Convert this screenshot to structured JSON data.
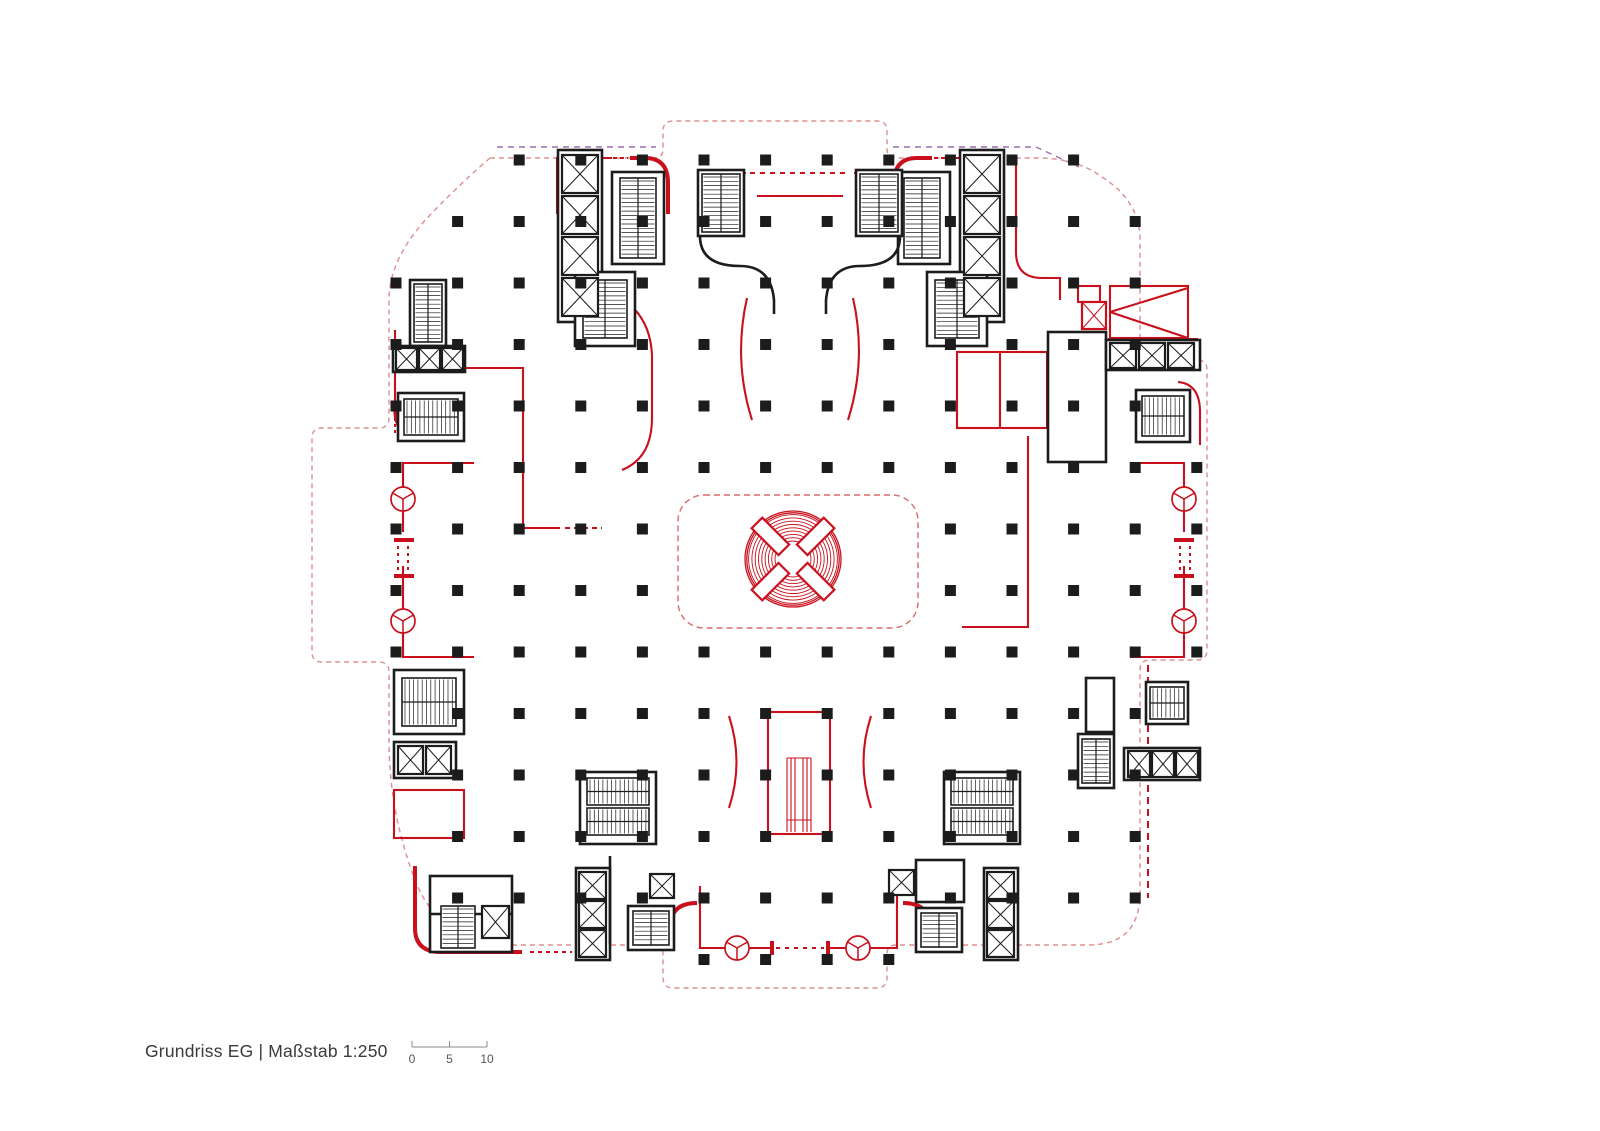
{
  "title": "Grundriss EG | Maßstab 1:250",
  "scale_bar": {
    "labels": [
      "0",
      "5",
      "10"
    ],
    "tick_x": [
      412,
      449.5,
      487
    ],
    "line_y": 1047,
    "tick_top": 1041,
    "label_y": 1063,
    "x_start": 412,
    "x_end": 487
  },
  "colors": {
    "red": "#c9101c",
    "red_light": "#d96a6a",
    "black": "#1c1c1c",
    "boundary": "#dd8f8f",
    "violet": "#9a6fae",
    "text": "#3a3a3a",
    "scale_line": "#8a8a8a",
    "white": "#ffffff"
  },
  "plan": {
    "boundary_path": "M 490,158 H 654 Q 663,158 663,149 V 131 Q 663,121 673,121 H 877 Q 887,121 887,131 V 149 Q 887,158 896,158 H 1038 Q 1076,158 1102,177 Q 1140,201 1140,240 V 350 Q 1140,360 1150,360 H 1197 Q 1207,360 1207,370 V 650 Q 1207,660 1197,660 H 1150 Q 1140,660 1140,670 V 893 Q 1140,945 1088,945 H 896 Q 887,945 887,954 V 977 Q 887,988 877,988 H 673 Q 663,988 663,977 V 954 Q 663,945 654,945 H 516 Q 440,945 415,880 Q 389,812 389,740 V 672 Q 389,662 379,662 H 322 Q 312,662 312,652 V 438 Q 312,428 322,428 H 379 Q 389,428 389,418 V 300 Q 389,258 430,215 Q 462,182 490,158 Z",
    "violet_paths": [
      "M 497,147 H 656",
      "M 893,147 H 1036 L 1079,167"
    ],
    "atrium": {
      "x": 678,
      "y": 495,
      "w": 240,
      "h": 133,
      "r": 26
    },
    "rotunda": {
      "cx": 793,
      "cy": 559,
      "ring_radii": [
        18,
        21.3,
        24.6,
        27.9,
        31.2,
        34.5,
        37.8,
        41.1,
        44.4
      ],
      "outer_radii": [
        46.2,
        48
      ],
      "paddle_angles": [
        45,
        135,
        225,
        315
      ],
      "paddle_r": 32,
      "paddle_len": 38,
      "paddle_w": 15
    },
    "columns": {
      "x0": 396,
      "dx": 61.6,
      "nx": 14,
      "y0": 160,
      "dy": 61.5,
      "ny": 14,
      "size": 11,
      "exclude": [
        [
          5,
          6
        ],
        [
          6,
          6
        ],
        [
          7,
          6
        ],
        [
          8,
          6
        ],
        [
          5,
          7
        ],
        [
          6,
          7
        ],
        [
          7,
          7
        ],
        [
          8,
          7
        ],
        [
          0,
          0
        ],
        [
          1,
          0
        ],
        [
          12,
          0
        ],
        [
          13,
          0
        ],
        [
          0,
          1
        ],
        [
          13,
          1
        ],
        [
          13,
          2
        ],
        [
          13,
          3
        ],
        [
          13,
          4
        ],
        [
          13,
          9
        ],
        [
          13,
          10
        ],
        [
          13,
          11
        ],
        [
          13,
          12
        ],
        [
          13,
          13
        ],
        [
          12,
          13
        ],
        [
          11,
          13
        ],
        [
          10,
          13
        ],
        [
          9,
          13
        ],
        [
          4,
          13
        ],
        [
          3,
          13
        ],
        [
          2,
          13
        ],
        [
          1,
          13
        ],
        [
          0,
          13
        ],
        [
          0,
          9
        ],
        [
          0,
          10
        ],
        [
          0,
          11
        ],
        [
          0,
          12
        ]
      ]
    },
    "black_rects": [
      {
        "x": 558,
        "y": 150,
        "w": 44,
        "h": 172
      },
      {
        "x": 612,
        "y": 172,
        "w": 52,
        "h": 92
      },
      {
        "x": 575,
        "y": 272,
        "w": 60,
        "h": 74
      },
      {
        "x": 960,
        "y": 150,
        "w": 44,
        "h": 172
      },
      {
        "x": 898,
        "y": 172,
        "w": 52,
        "h": 92
      },
      {
        "x": 927,
        "y": 272,
        "w": 60,
        "h": 74
      },
      {
        "x": 698,
        "y": 170,
        "w": 46,
        "h": 66
      },
      {
        "x": 856,
        "y": 170,
        "w": 46,
        "h": 66
      },
      {
        "x": 410,
        "y": 280,
        "w": 36,
        "h": 66
      },
      {
        "x": 393,
        "y": 346,
        "w": 72,
        "h": 26
      },
      {
        "x": 398,
        "y": 393,
        "w": 66,
        "h": 48
      },
      {
        "x": 1048,
        "y": 332,
        "w": 58,
        "h": 130
      },
      {
        "x": 1106,
        "y": 340,
        "w": 94,
        "h": 30
      },
      {
        "x": 1136,
        "y": 390,
        "w": 54,
        "h": 52
      },
      {
        "x": 1086,
        "y": 678,
        "w": 28,
        "h": 54
      },
      {
        "x": 1078,
        "y": 734,
        "w": 36,
        "h": 54
      },
      {
        "x": 1124,
        "y": 748,
        "w": 76,
        "h": 32
      },
      {
        "x": 1146,
        "y": 682,
        "w": 42,
        "h": 42
      },
      {
        "x": 394,
        "y": 670,
        "w": 70,
        "h": 64
      },
      {
        "x": 394,
        "y": 742,
        "w": 62,
        "h": 36
      },
      {
        "x": 430,
        "y": 876,
        "w": 82,
        "h": 76
      },
      {
        "x": 580,
        "y": 772,
        "w": 76,
        "h": 72
      },
      {
        "x": 576,
        "y": 868,
        "w": 34,
        "h": 92
      },
      {
        "x": 628,
        "y": 906,
        "w": 46,
        "h": 44
      },
      {
        "x": 944,
        "y": 772,
        "w": 76,
        "h": 72
      },
      {
        "x": 984,
        "y": 868,
        "w": 34,
        "h": 92
      },
      {
        "x": 916,
        "y": 860,
        "w": 48,
        "h": 42
      },
      {
        "x": 916,
        "y": 908,
        "w": 46,
        "h": 44
      }
    ],
    "black_paths": [
      "M 700,236 Q 700,266 740,266 Q 771,266 774,300 V 314",
      "M 900,236 Q 900,266 860,266 Q 829,266 826,300 V 314",
      "M 610,856 V 944",
      "M 430,914 H 512"
    ],
    "stairs": [
      {
        "x": 620,
        "y": 178,
        "w": 36,
        "h": 80,
        "dir": "v"
      },
      {
        "x": 583,
        "y": 280,
        "w": 44,
        "h": 58,
        "dir": "v"
      },
      {
        "x": 904,
        "y": 178,
        "w": 36,
        "h": 80,
        "dir": "v"
      },
      {
        "x": 935,
        "y": 280,
        "w": 44,
        "h": 58,
        "dir": "v"
      },
      {
        "x": 702,
        "y": 174,
        "w": 38,
        "h": 58,
        "dir": "v"
      },
      {
        "x": 860,
        "y": 174,
        "w": 38,
        "h": 58,
        "dir": "v"
      },
      {
        "x": 414,
        "y": 284,
        "w": 28,
        "h": 58,
        "dir": "v"
      },
      {
        "x": 404,
        "y": 399,
        "w": 54,
        "h": 36,
        "dir": "h"
      },
      {
        "x": 1142,
        "y": 396,
        "w": 42,
        "h": 40,
        "dir": "h"
      },
      {
        "x": 1082,
        "y": 739,
        "w": 28,
        "h": 44,
        "dir": "v"
      },
      {
        "x": 1150,
        "y": 687,
        "w": 34,
        "h": 32,
        "dir": "h"
      },
      {
        "x": 402,
        "y": 678,
        "w": 54,
        "h": 48,
        "dir": "h"
      },
      {
        "x": 441,
        "y": 906,
        "w": 34,
        "h": 42,
        "dir": "v"
      },
      {
        "x": 587,
        "y": 778,
        "w": 62,
        "h": 27,
        "dir": "h"
      },
      {
        "x": 587,
        "y": 808,
        "w": 62,
        "h": 27,
        "dir": "h"
      },
      {
        "x": 633,
        "y": 911,
        "w": 36,
        "h": 34,
        "dir": "v"
      },
      {
        "x": 951,
        "y": 778,
        "w": 62,
        "h": 27,
        "dir": "h"
      },
      {
        "x": 951,
        "y": 808,
        "w": 62,
        "h": 27,
        "dir": "h"
      },
      {
        "x": 921,
        "y": 913,
        "w": 36,
        "h": 34,
        "dir": "v"
      }
    ],
    "elevators": [
      {
        "x": 562,
        "y": 155,
        "w": 36,
        "h": 38
      },
      {
        "x": 562,
        "y": 196,
        "w": 36,
        "h": 38
      },
      {
        "x": 562,
        "y": 237,
        "w": 36,
        "h": 38
      },
      {
        "x": 562,
        "y": 278,
        "w": 36,
        "h": 38
      },
      {
        "x": 964,
        "y": 155,
        "w": 36,
        "h": 38
      },
      {
        "x": 964,
        "y": 196,
        "w": 36,
        "h": 38
      },
      {
        "x": 964,
        "y": 237,
        "w": 36,
        "h": 38
      },
      {
        "x": 964,
        "y": 278,
        "w": 36,
        "h": 38
      },
      {
        "x": 396,
        "y": 348,
        "w": 21,
        "h": 22
      },
      {
        "x": 419,
        "y": 348,
        "w": 21,
        "h": 22
      },
      {
        "x": 442,
        "y": 348,
        "w": 21,
        "h": 22
      },
      {
        "x": 1110,
        "y": 343,
        "w": 26,
        "h": 25
      },
      {
        "x": 1139,
        "y": 343,
        "w": 26,
        "h": 25
      },
      {
        "x": 1168,
        "y": 343,
        "w": 26,
        "h": 25
      },
      {
        "x": 1128,
        "y": 751,
        "w": 22,
        "h": 26
      },
      {
        "x": 1152,
        "y": 751,
        "w": 22,
        "h": 26
      },
      {
        "x": 1176,
        "y": 751,
        "w": 22,
        "h": 26
      },
      {
        "x": 398,
        "y": 746,
        "w": 25,
        "h": 28
      },
      {
        "x": 426,
        "y": 746,
        "w": 25,
        "h": 28
      },
      {
        "x": 482,
        "y": 906,
        "w": 27,
        "h": 32
      },
      {
        "x": 579,
        "y": 872,
        "w": 27,
        "h": 27
      },
      {
        "x": 579,
        "y": 901,
        "w": 27,
        "h": 27
      },
      {
        "x": 579,
        "y": 930,
        "w": 27,
        "h": 27
      },
      {
        "x": 650,
        "y": 874,
        "w": 24,
        "h": 24
      },
      {
        "x": 987,
        "y": 872,
        "w": 27,
        "h": 27
      },
      {
        "x": 987,
        "y": 901,
        "w": 27,
        "h": 27
      },
      {
        "x": 987,
        "y": 930,
        "w": 27,
        "h": 27
      },
      {
        "x": 889,
        "y": 870,
        "w": 25,
        "h": 25
      }
    ],
    "red_elevators": [
      {
        "x": 1082,
        "y": 302,
        "w": 24,
        "h": 27
      }
    ],
    "red_rects": [
      {
        "x": 394,
        "y": 790,
        "w": 70,
        "h": 48
      },
      {
        "x": 957,
        "y": 352,
        "w": 90,
        "h": 76
      },
      {
        "x": 1110,
        "y": 286,
        "w": 78,
        "h": 52
      },
      {
        "x": 1078,
        "y": 286,
        "w": 22,
        "h": 16
      },
      {
        "x": 768,
        "y": 712,
        "w": 62,
        "h": 122
      }
    ],
    "red_paths": [
      "M 474,463 H 403 V 532",
      "M 403,566 V 657 H 474",
      "M 1130,463 H 1184 V 532",
      "M 1184,566 V 657 H 1130",
      "M 700,886 V 948 H 772",
      "M 828,948 H 897 V 886",
      "M 700,238 V 173 H 746",
      "M 900,238 V 173 H 854",
      "M 757,196 H 843",
      "M 557,214 V 158 H 612",
      "M 1004,214 V 158 H 950",
      "M 395,330 V 405",
      "M 395,368 H 462",
      "M 462,368 H 523 V 528 H 560",
      "M 1000,352 V 428",
      "M 1028,436 V 627 H 962",
      "M 1016,158 V 252 Q 1016,278 1042,278 H 1060 V 300",
      "M 1110,312 L 1188,288",
      "M 1110,312 L 1188,338",
      "M 1178,382 Q 1200,384 1200,412 V 445",
      "M 747,298 Q 733,360 752,420",
      "M 853,298 Q 867,360 848,420",
      "M 729,716 Q 744,762 729,808",
      "M 871,716 Q 856,762 871,808",
      "M 620,298 Q 650,315 652,355 V 418 Q 652,458 622,470"
    ],
    "red_thin_paths": [
      "M 787,758 V 832",
      "M 791,758 V 832",
      "M 795,758 V 832",
      "M 803,758 V 832",
      "M 807,758 V 832",
      "M 811,758 V 832",
      "M 787,758 H 811",
      "M 787,820 H 811"
    ],
    "red_thick_paths": [
      "M 630,158 H 645 Q 668,158 668,183 V 214",
      "M 932,158 H 917 Q 894,158 894,183 V 214",
      "M 395,405 Q 395,438 420,438 H 450",
      "M 1108,340 H 1198",
      "M 415,866 V 928 Q 415,952 441,952 H 522",
      "M 697,903 Q 670,903 670,928 V 947",
      "M 903,903 Q 930,903 930,928 V 947",
      "M 394,540 H 414",
      "M 394,576 H 414",
      "M 1174,540 H 1194",
      "M 1174,576 H 1194",
      "M 772,941 V 955",
      "M 828,941 V 955"
    ],
    "red_dashed_paths": [
      {
        "d": "M 398,546 V 572",
        "dash": "3 4"
      },
      {
        "d": "M 408,546 V 572",
        "dash": "3 4"
      },
      {
        "d": "M 1180,546 V 572",
        "dash": "3 4"
      },
      {
        "d": "M 1190,546 V 572",
        "dash": "3 4"
      },
      {
        "d": "M 776,948 H 824",
        "dash": "4 5"
      },
      {
        "d": "M 750,173 H 850",
        "dash": "5 5"
      },
      {
        "d": "M 613,158 H 628",
        "dash": "4 3"
      },
      {
        "d": "M 934,158 H 948",
        "dash": "4 3"
      },
      {
        "d": "M 1148,665 V 898",
        "dash": "7 5"
      },
      {
        "d": "M 530,952 H 572",
        "dash": "4 4"
      },
      {
        "d": "M 565,528 H 602",
        "dash": "5 4"
      },
      {
        "d": "M 395,418 V 435",
        "dash": "3 3"
      }
    ],
    "revolving_doors": [
      {
        "cx": 403,
        "cy": 499,
        "r": 12
      },
      {
        "cx": 403,
        "cy": 621,
        "r": 12
      },
      {
        "cx": 1184,
        "cy": 499,
        "r": 12
      },
      {
        "cx": 1184,
        "cy": 621,
        "r": 12
      },
      {
        "cx": 737,
        "cy": 948,
        "r": 12
      },
      {
        "cx": 858,
        "cy": 948,
        "r": 12
      }
    ]
  }
}
